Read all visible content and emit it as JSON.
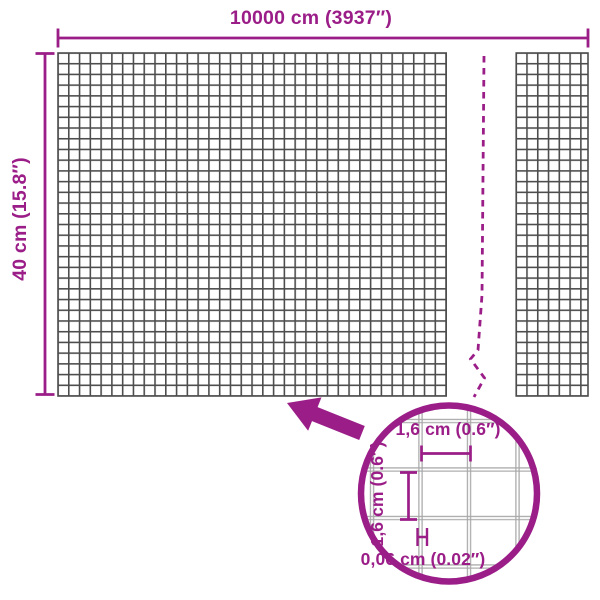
{
  "colors": {
    "accent": "#9B1E88",
    "mesh": "#4D4D4D",
    "detail_mesh": "#A6A6A6",
    "background": "#FFFFFF"
  },
  "dimensions": {
    "width_label": "10000 cm (3937″)",
    "height_label": "40 cm (15.8″)"
  },
  "detail": {
    "cell_width_label": "1,6 cm (0.6″)",
    "cell_height_label": "1,6 cm (0.6″)",
    "wire_thickness_label": "0,06 cm (0.02″)"
  }
}
